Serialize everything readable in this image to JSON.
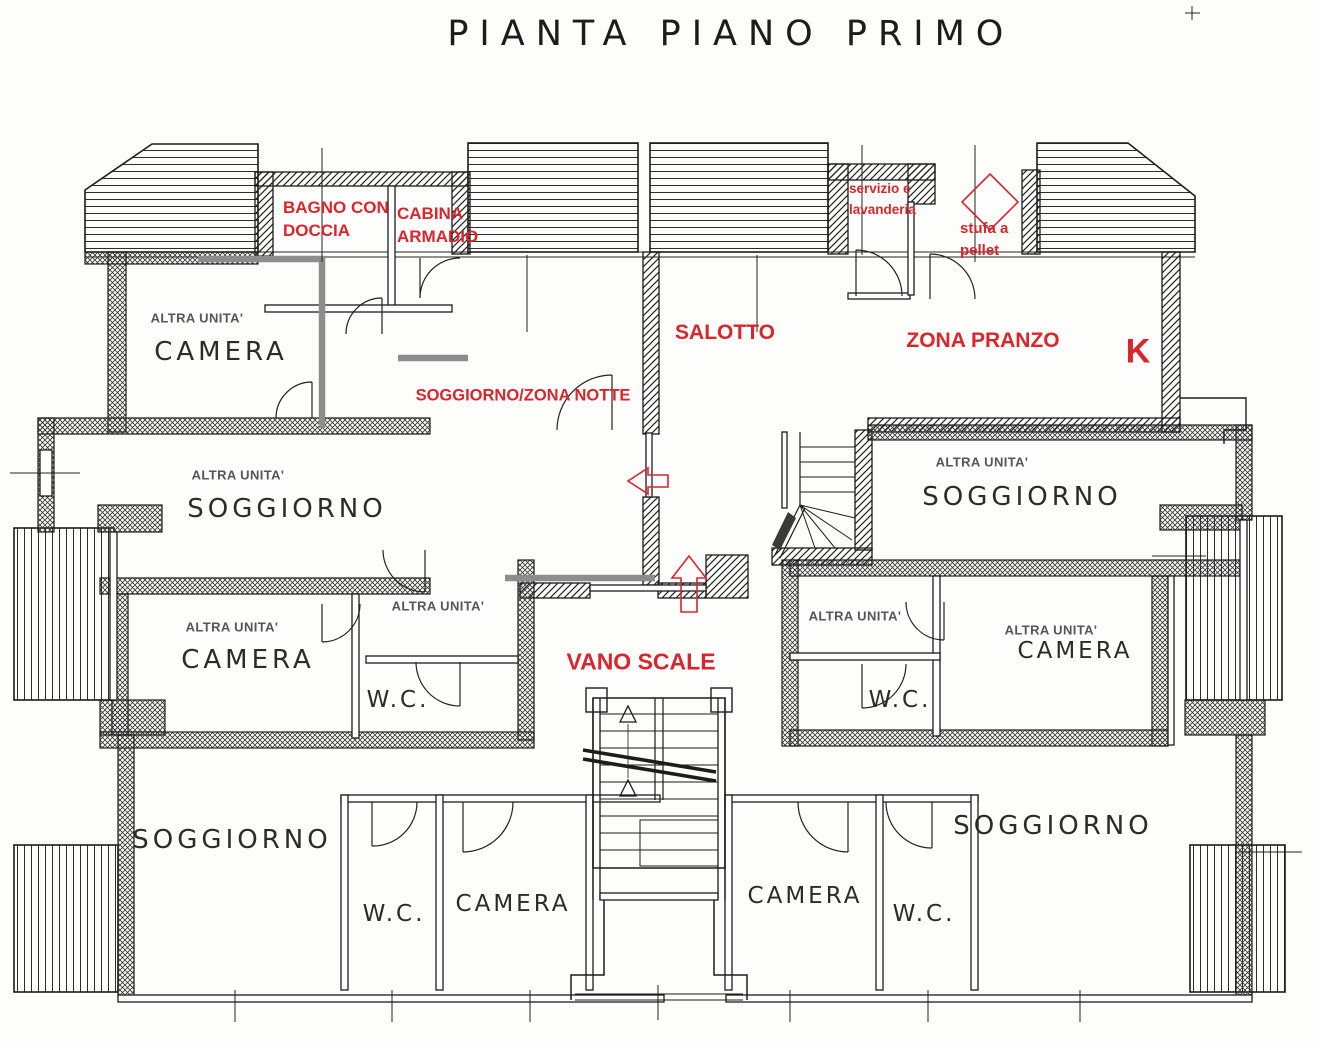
{
  "title": "PIANTA PIANO PRIMO",
  "colors": {
    "annotation_red": "#d8262c",
    "ink": "#1c1c1c",
    "unit_boundary_gray": "#8d8d8d"
  },
  "shared_labels": {
    "altra_unita": "ALTRA UNITA'",
    "camera": "CAMERA",
    "soggiorno": "SOGGIORNO",
    "wc": "W.C."
  },
  "annotations": {
    "bagno_con_doccia": "BAGNO CON DOCCIA",
    "cabina_armadio": "CABINA ARMADIO",
    "servizio_e_lavanderia": "servizio e lavanderia",
    "stufa_a_pellet": "stufa a pellet",
    "salotto": "SALOTTO",
    "zona_pranzo": "ZONA PRANZO",
    "kitchen_k": "K",
    "soggiorno_zona_notte": "SOGGIORNO/ZONA NOTTE",
    "vano_scale": "VANO SCALE"
  }
}
